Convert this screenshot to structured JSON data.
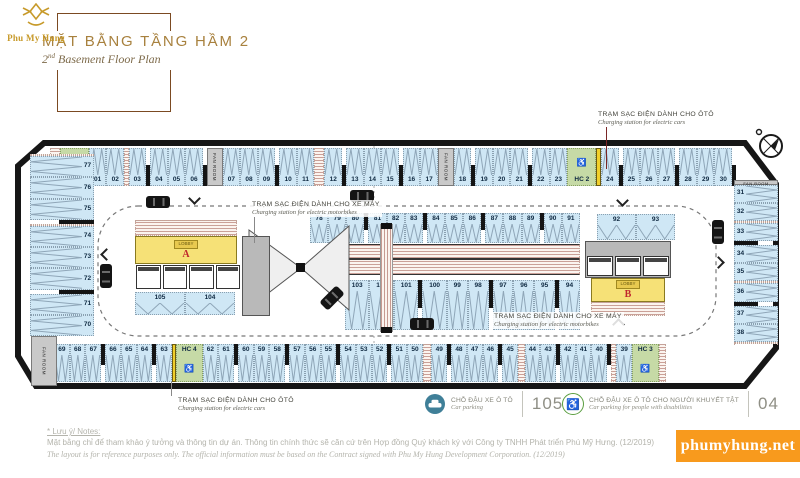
{
  "header": {
    "brand": "Phu My Hung",
    "title_vi": "MẶT BẰNG TẦNG HẦM 2",
    "title_en": {
      "num": "2",
      "sup": "nd",
      "rest": " Basement Floor Plan"
    }
  },
  "plan": {
    "fan_room_label": "FAN ROOM",
    "top_row": [
      {
        "t": "moto",
        "w": 0.9
      },
      {
        "t": "hc",
        "n": "HC 1"
      },
      {
        "t": "car",
        "n": "01"
      },
      {
        "t": "car",
        "n": "02"
      },
      {
        "t": "moto",
        "w": 0.3
      },
      {
        "t": "car",
        "n": "03"
      },
      {
        "t": "car",
        "n": "04"
      },
      {
        "t": "car",
        "n": "05"
      },
      {
        "t": "car",
        "n": "06"
      },
      {
        "t": "room",
        "n": "FAN ROOM"
      },
      {
        "t": "car",
        "n": "07"
      },
      {
        "t": "car",
        "n": "08"
      },
      {
        "t": "car",
        "n": "09"
      },
      {
        "t": "car",
        "n": "10"
      },
      {
        "t": "car",
        "n": "11"
      },
      {
        "t": "moto"
      },
      {
        "t": "car",
        "n": "12"
      },
      {
        "t": "car",
        "n": "13"
      },
      {
        "t": "car",
        "n": "14"
      },
      {
        "t": "car",
        "n": "15"
      },
      {
        "t": "car",
        "n": "16"
      },
      {
        "t": "car",
        "n": "17"
      },
      {
        "t": "room",
        "n": "FAN ROOM"
      },
      {
        "t": "car",
        "n": "18"
      },
      {
        "t": "car",
        "n": "19"
      },
      {
        "t": "car",
        "n": "20"
      },
      {
        "t": "car",
        "n": "21"
      },
      {
        "t": "car",
        "n": "22"
      },
      {
        "t": "car",
        "n": "23"
      },
      {
        "t": "hc",
        "n": "HC 2"
      },
      {
        "t": "chg"
      },
      {
        "t": "car",
        "n": "24"
      },
      {
        "t": "car",
        "n": "25"
      },
      {
        "t": "car",
        "n": "26"
      },
      {
        "t": "car",
        "n": "27"
      },
      {
        "t": "car",
        "n": "28"
      },
      {
        "t": "car",
        "n": "29"
      },
      {
        "t": "car",
        "n": "30"
      }
    ],
    "right_col": [
      {
        "t": "room",
        "n": "FAN ROOM"
      },
      {
        "t": "car",
        "n": "31"
      },
      {
        "t": "car",
        "n": "32"
      },
      {
        "t": "moto",
        "w": 0.3
      },
      {
        "t": "car",
        "n": "33"
      },
      {
        "t": "car",
        "n": "34"
      },
      {
        "t": "car",
        "n": "35"
      },
      {
        "t": "moto",
        "w": 0.5
      },
      {
        "t": "car",
        "n": "36"
      },
      {
        "t": "car",
        "n": "37"
      },
      {
        "t": "car",
        "n": "38"
      },
      {
        "t": "moto",
        "w": 0.7
      }
    ],
    "bottom_row": [
      {
        "t": "car",
        "n": "69"
      },
      {
        "t": "car",
        "n": "68"
      },
      {
        "t": "car",
        "n": "67"
      },
      {
        "t": "car",
        "n": "66"
      },
      {
        "t": "car",
        "n": "65"
      },
      {
        "t": "car",
        "n": "64"
      },
      {
        "t": "car",
        "n": "63"
      },
      {
        "t": "chg"
      },
      {
        "t": "hc",
        "n": "HC 4"
      },
      {
        "t": "car",
        "n": "62"
      },
      {
        "t": "car",
        "n": "61"
      },
      {
        "t": "car",
        "n": "60"
      },
      {
        "t": "car",
        "n": "59"
      },
      {
        "t": "car",
        "n": "58"
      },
      {
        "t": "car",
        "n": "57"
      },
      {
        "t": "car",
        "n": "56"
      },
      {
        "t": "car",
        "n": "55"
      },
      {
        "t": "car",
        "n": "54"
      },
      {
        "t": "car",
        "n": "53"
      },
      {
        "t": "car",
        "n": "52"
      },
      {
        "t": "car",
        "n": "51"
      },
      {
        "t": "car",
        "n": "50"
      },
      {
        "t": "moto"
      },
      {
        "t": "car",
        "n": "49"
      },
      {
        "t": "car",
        "n": "48"
      },
      {
        "t": "car",
        "n": "47"
      },
      {
        "t": "car",
        "n": "46"
      },
      {
        "t": "car",
        "n": "45"
      },
      {
        "t": "moto",
        "w": 0.7
      },
      {
        "t": "car",
        "n": "44"
      },
      {
        "t": "car",
        "n": "43"
      },
      {
        "t": "car",
        "n": "42"
      },
      {
        "t": "car",
        "n": "41"
      },
      {
        "t": "car",
        "n": "40"
      },
      {
        "t": "moto",
        "w": 0.5
      },
      {
        "t": "car",
        "n": "39"
      },
      {
        "t": "hc",
        "n": "HC 3"
      },
      {
        "t": "moto",
        "w": 0.8
      }
    ],
    "left_col": [
      {
        "t": "moto",
        "w": 1.3
      },
      {
        "t": "car",
        "n": "77"
      },
      {
        "t": "car",
        "n": "76"
      },
      {
        "t": "car",
        "n": "75"
      },
      {
        "t": "moto",
        "w": 0.35
      },
      {
        "t": "car",
        "n": "74"
      },
      {
        "t": "car",
        "n": "73"
      },
      {
        "t": "car",
        "n": "72"
      },
      {
        "t": "car",
        "n": "71"
      },
      {
        "t": "car",
        "n": "70"
      }
    ],
    "island_top": [
      {
        "t": "car",
        "n": "78"
      },
      {
        "t": "car",
        "n": "79"
      },
      {
        "t": "car",
        "n": "80"
      },
      {
        "t": "car",
        "n": "81"
      },
      {
        "t": "car",
        "n": "82"
      },
      {
        "t": "car",
        "n": "83"
      },
      {
        "t": "car",
        "n": "84"
      },
      {
        "t": "car",
        "n": "85"
      },
      {
        "t": "car",
        "n": "86"
      },
      {
        "t": "car",
        "n": "87"
      },
      {
        "t": "car",
        "n": "88"
      },
      {
        "t": "car",
        "n": "89"
      },
      {
        "t": "car",
        "n": "90"
      },
      {
        "t": "car",
        "n": "91"
      }
    ],
    "island_bottom": [
      {
        "t": "car",
        "n": "103"
      },
      {
        "t": "car",
        "n": "102"
      },
      {
        "t": "car",
        "n": "101"
      },
      {
        "t": "car",
        "n": "100"
      },
      {
        "t": "car",
        "n": "99"
      },
      {
        "t": "car",
        "n": "98"
      },
      {
        "t": "car",
        "n": "97"
      },
      {
        "t": "car",
        "n": "96"
      },
      {
        "t": "car",
        "n": "95"
      },
      {
        "t": "car",
        "n": "94"
      }
    ],
    "core_a": {
      "letter": "A",
      "lobby": "LOBBY",
      "stalls": [
        {
          "t": "car",
          "n": "105"
        },
        {
          "t": "car",
          "n": "104"
        }
      ]
    },
    "core_b": {
      "letter": "B",
      "lobby": "LOBBY",
      "stalls": [
        {
          "t": "car",
          "n": "92"
        },
        {
          "t": "car",
          "n": "93"
        }
      ]
    }
  },
  "annotations": {
    "moto_top": {
      "vi": "TRẠM SẠC ĐIỆN DÀNH CHO XE MÁY",
      "en": "Charging station for electric motorbikes"
    },
    "car_top": {
      "vi": "TRẠM SẠC ĐIỆN DÀNH CHO ÔTÔ",
      "en": "Charging station for electric cars"
    },
    "moto_center": {
      "vi": "TRẠM SẠC ĐIỆN DÀNH CHO XE MÁY",
      "en": "Charging station for electric motorbikes"
    },
    "car_bottom": {
      "vi": "TRẠM SẠC ĐIỆN DÀNH CHO ÔTÔ",
      "en": "Charging station for electric cars"
    }
  },
  "legend": {
    "car": {
      "vi": "CHỖ ĐẬU XE Ô TÔ",
      "en": "Car parking",
      "count": "105"
    },
    "disabled": {
      "vi": "CHỖ ĐẬU XE Ô TÔ CHO NGƯỜI KHUYẾT TẬT",
      "en": "Car parking for people with disabilities",
      "count": "04"
    }
  },
  "notes": {
    "heading": "* Lưu ý/ Notes:",
    "vi": "Mặt bằng chỉ để tham khảo ý tưởng và thông tin dự án. Thông tin chính thức sẽ căn cứ trên Hợp đồng Quý khách ký với Công ty TNHH Phát triển Phú Mỹ Hưng. (12/2019)",
    "en": "The layout is for reference purposes only. The official information must be based on the Contract signed with Phu My Hung Development Corporation. (12/2019)"
  },
  "watermark": "phumyhung.net",
  "colors": {
    "brand_gold": "#c79a2a",
    "title_gold": "#a8813e",
    "stall_blue": "#cfe7f5",
    "accessible_green": "#c6daa6",
    "charger_yellow": "#f0cf2b",
    "lobby_yellow": "#f6e177",
    "core_letter_red": "#c0272d",
    "watermark_orange": "#f89a1d",
    "wall_black": "#161616",
    "legend_teal": "#3f7f98",
    "legend_green": "#5a9e3f"
  }
}
